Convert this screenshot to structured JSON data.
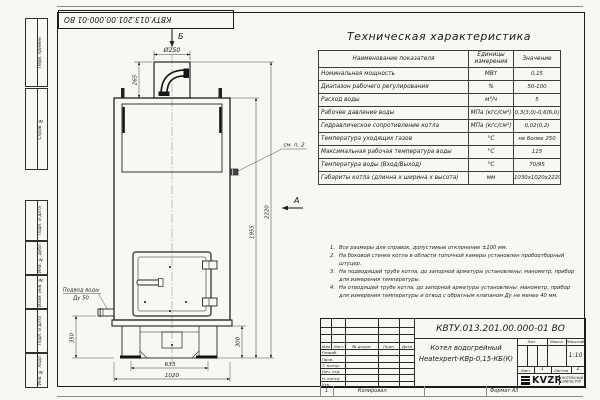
{
  "frame": {
    "designation_top": "КВТУ.013.201.00.000-01 ВО",
    "side_labels": [
      {
        "label": "Перв. примен."
      },
      {
        "label": "Справ. №"
      },
      {
        "label": "Подп. и дата"
      },
      {
        "label": "Инв. № дубл."
      },
      {
        "label": "Взам. инв. №"
      },
      {
        "label": "Подп. и дата"
      },
      {
        "label": "Инв. № подл."
      }
    ]
  },
  "drawing": {
    "view_labels": {
      "top": "Б",
      "side": "А"
    },
    "callouts": {
      "see_note": "см. п. 2",
      "water_supply_line1": "Подвод воды",
      "water_supply_line2": "Ду 50"
    },
    "dims": {
      "chimney_dia": "Ø250",
      "chimney_h": "265",
      "total_h": "2220",
      "body_h": "1955",
      "base_h": "300",
      "inlet_h": "350",
      "base_w": "633",
      "body_w": "1020"
    }
  },
  "spec_table": {
    "title": "Техническая характеристика",
    "headers": [
      "Наименование показателя",
      "Единицы измерения",
      "Значение"
    ],
    "rows": [
      [
        "Номинальная мощность",
        "МВт",
        "0,15"
      ],
      [
        "Диапазон рабочего регулирования",
        "%",
        "50-100"
      ],
      [
        "Расход воды",
        "м³/ч",
        "5"
      ],
      [
        "Рабочее давление воды",
        "МПа (кгс/см²)",
        "0,3(3,0)-0,6(6,0)"
      ],
      [
        "Гидравлическое сопротивление котла",
        "МПа (кгс/см²)",
        "0,02(0,2)"
      ],
      [
        "Температура уходящих газов",
        "°С",
        "не более 250"
      ],
      [
        "Максимальная рабочая температура воды",
        "°С",
        "115"
      ],
      [
        "Температура воды (Вход/Выход)",
        "°С",
        "70/95"
      ],
      [
        "Габариты котла (длинна х ширина х высота)",
        "мм",
        "1030х1020х2220"
      ]
    ]
  },
  "notes": [
    {
      "n": "1.",
      "text": "Все размеры для справок, допустимые отклонение ±100 мм."
    },
    {
      "n": "2.",
      "text": "На боковой стенке котла в области топочной камеры установлен пробоотборный штуцер."
    },
    {
      "n": "3.",
      "text": "На подводящей трубе котла, до запорной арматуры установлены: манометр, прибор для измерения температуры."
    },
    {
      "n": "4.",
      "text": "На отводящей трубе котла, до запорной арматуры установлены: манометр, прибор для измерения температуры и отвод с обратным клапаном Ду не менее 40 мм."
    }
  ],
  "title_block": {
    "designation": "КВТУ.013.201.00.000-01 ВО",
    "doc_name_line1": "Котел водогрейный",
    "doc_name_line2": "Heatexpert-КВр-0,15-КБ(К)",
    "header_cols": [
      "Изм",
      "Лист",
      "№ докум.",
      "Подп.",
      "Дата"
    ],
    "sign_rows": [
      "Разраб.",
      "Пров.",
      "Т. контр.",
      "Нач. отд.",
      "Н. контр.",
      "Утв."
    ],
    "lit_label": "Лит.",
    "mass_label": "Масса",
    "scale_label": "Масштаб",
    "scale_value": "1:10",
    "sheet_label": "Лист",
    "sheet_value": "1",
    "sheets_label": "Листов",
    "sheets_value": "2",
    "logo_text": "KVZR",
    "company_line1": "КОТЕЛЬНЫЙ",
    "company_line2": "ЗАВОД РЭП",
    "footer_zone": "1",
    "footer_copy": "Копировал",
    "footer_format": "Формат А3"
  }
}
